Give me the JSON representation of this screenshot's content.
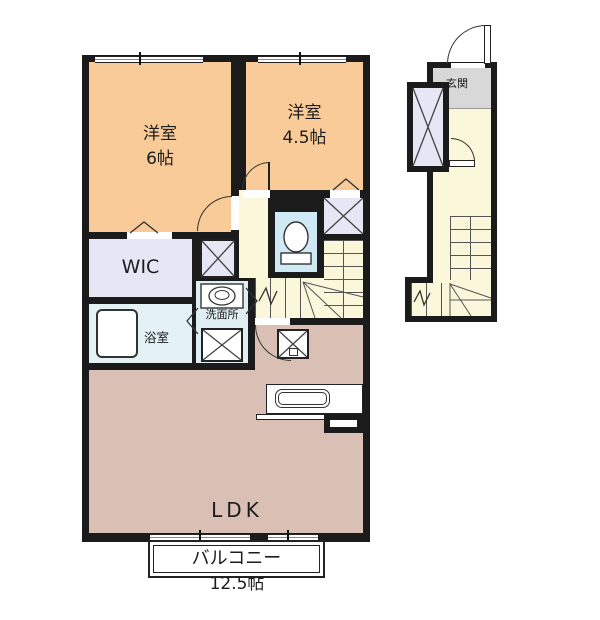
{
  "floorplan": {
    "rooms": {
      "bedroom6": {
        "label": "洋室",
        "size": "6帖"
      },
      "bedroom45": {
        "label": "洋室",
        "size": "4.5帖"
      },
      "wic": {
        "label": "WIC"
      },
      "bathroom": {
        "label": "浴室"
      },
      "washroom": {
        "label": "洗面所"
      },
      "ldk": {
        "label": "LDK",
        "size": "12.5帖"
      },
      "balcony": {
        "label": "バルコニー"
      },
      "entrance": {
        "label": "玄関"
      }
    },
    "icons": {
      "closet_x": "crossed-box storage marker",
      "washer_x": "washing-machine space marker",
      "fridge_x": "refrigerator space marker",
      "toilet": "toilet bowl",
      "bathtub": "bathtub",
      "sink": "vanity sink",
      "kitchen_sink": "kitchen counter sink",
      "stairs": "staircase treads with direction arrow",
      "door_arc": "door swing arc",
      "folding_door": "folding door chevron",
      "window": "sliding window band"
    },
    "colors": {
      "wall": "#1b1b1b",
      "bedroom": "#f8cb99",
      "hall": "#fbf7da",
      "closet": "#e6e6f5",
      "toilet": "#cfe9f5",
      "washroom": "#dfeef3",
      "bathroom": "#e4f2f6",
      "ldk": "#d9bfb4",
      "entrance_floor": "#d8d8d8",
      "balcony": "#ffffff"
    }
  }
}
